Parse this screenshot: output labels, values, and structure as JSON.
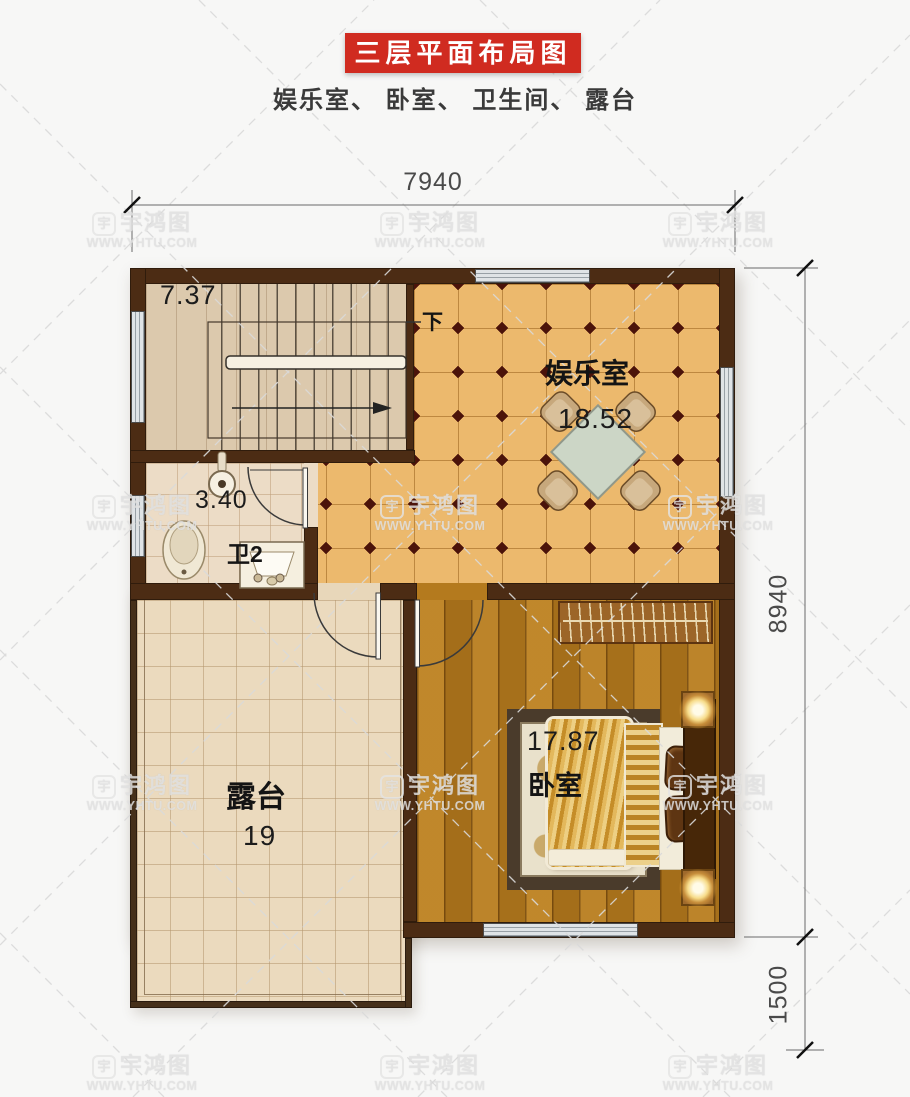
{
  "header": {
    "title": "三层平面布局图",
    "subtitle": "娱乐室、 卧室、 卫生间、 露台"
  },
  "dimensions": {
    "top_width": "7940",
    "right_height": "8940",
    "right_lower": "1500"
  },
  "rooms": {
    "stairwell": {
      "area": "7.37",
      "down_label": "下"
    },
    "bathroom": {
      "name": "卫2",
      "area": "3.40"
    },
    "entertainment": {
      "name": "娱乐室",
      "area": "18.52"
    },
    "bedroom": {
      "name": "卧室",
      "area": "17.87"
    },
    "terrace": {
      "name": "露台",
      "area": "19"
    }
  },
  "watermark": {
    "logo_char": "宇",
    "name": "宇鸿图",
    "url": "WWW.YHTU.COM"
  },
  "colors": {
    "accent_red": "#d02b20",
    "wall_brown": "#4c2c14",
    "tile_orange": "#ecb96d",
    "wood_brown": "#b47a1e",
    "terrace_beige": "#ebdabe",
    "table_green": "#ccd6c6"
  }
}
